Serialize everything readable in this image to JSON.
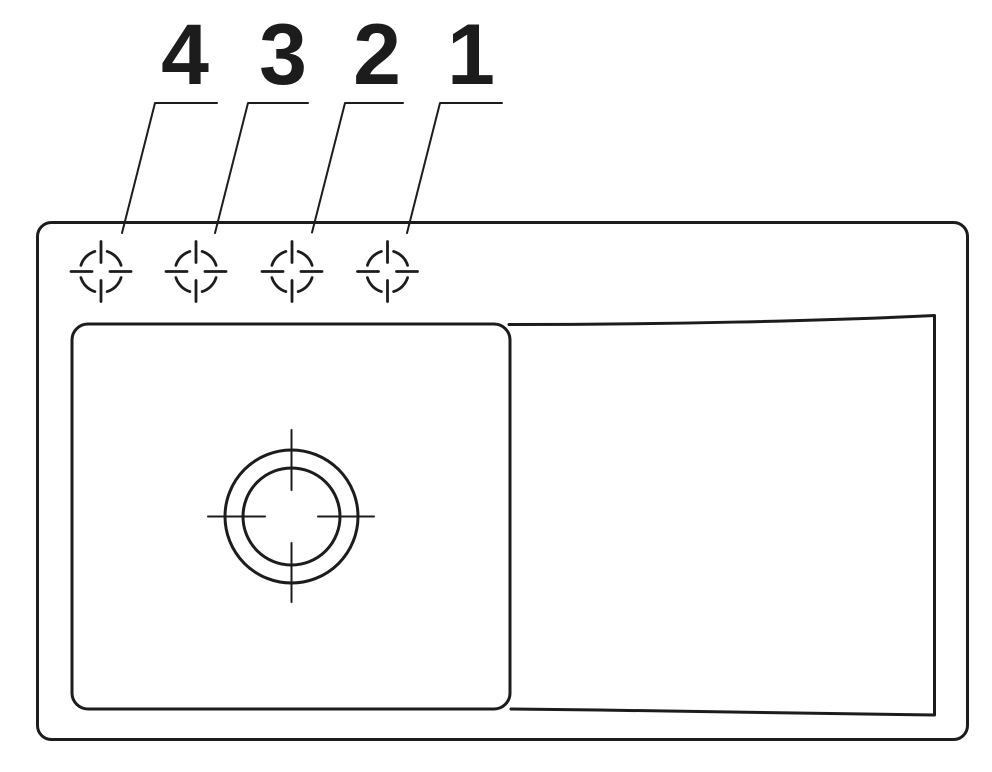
{
  "page": {
    "background": "#ffffff",
    "ink": "#1c1c1c",
    "description_labels_visible": [
      "4",
      "3",
      "2",
      "1"
    ]
  },
  "callouts": [
    {
      "label": "4",
      "label_x": 185,
      "label_baseline_y": 84,
      "leader": {
        "h_y": 103,
        "h_x1": 155,
        "h_x2": 217,
        "end_x": 122,
        "end_y": 233
      },
      "hole": {
        "cx": 101,
        "cy": 271.5
      }
    },
    {
      "label": "3",
      "label_x": 283,
      "label_baseline_y": 84,
      "leader": {
        "h_y": 103,
        "h_x1": 248,
        "h_x2": 308,
        "end_x": 215,
        "end_y": 233
      },
      "hole": {
        "cx": 196,
        "cy": 271.5
      }
    },
    {
      "label": "2",
      "label_x": 377,
      "label_baseline_y": 84,
      "leader": {
        "h_y": 103,
        "h_x1": 345,
        "h_x2": 403,
        "end_x": 312,
        "end_y": 232.5
      },
      "hole": {
        "cx": 292,
        "cy": 271.5
      }
    },
    {
      "label": "1",
      "label_x": 471,
      "label_baseline_y": 84,
      "leader": {
        "h_y": 103,
        "h_x1": 440,
        "h_x2": 502,
        "end_x": 407,
        "end_y": 233
      },
      "hole": {
        "cx": 387.5,
        "cy": 271.5
      }
    }
  ],
  "hole_marker_style": {
    "arc_radius": 21,
    "arc_gap_deg": 34,
    "tick_inner_r": 9,
    "tick_outer_r": 30
  },
  "sink": {
    "outer_rim": {
      "x": 37.5,
      "y": 222.5,
      "width": 930,
      "height": 517,
      "corner_radius": 14
    },
    "bowl": {
      "x": 72,
      "y": 324,
      "width": 438,
      "height": 385,
      "corner_radius": 16
    },
    "drainboard": {
      "top_start": [
        509,
        324.5
      ],
      "top_end": [
        934.5,
        315.5
      ],
      "right_x": 934.5,
      "bottom_start": [
        934.5,
        715
      ],
      "bottom_end": [
        511,
        709
      ]
    },
    "drain": {
      "cx": 291.5,
      "cy": 516.5,
      "outer_radius": 66.5,
      "inner_radius": 48.5,
      "centerline_v_segments": [
        [
          430,
          490
        ],
        [
          543,
          602
        ]
      ],
      "centerline_h_segments": [
        [
          208,
          265
        ],
        [
          318,
          374
        ]
      ]
    }
  }
}
